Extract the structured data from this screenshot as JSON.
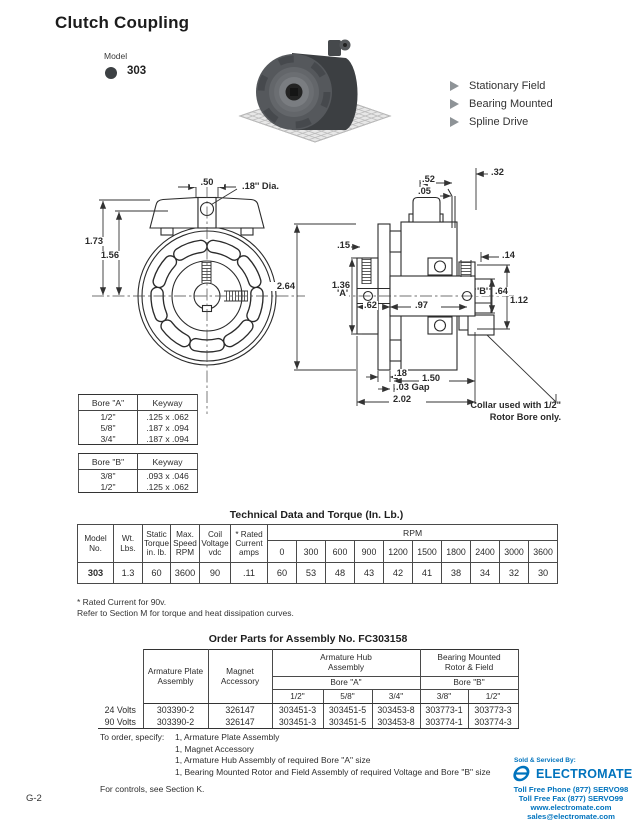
{
  "page_number": "G-2",
  "header": {
    "title": "Clutch Coupling",
    "model_label": "Model",
    "model_number": "303"
  },
  "features": [
    "Stationary Field",
    "Bearing Mounted",
    "Spline Drive"
  ],
  "icons": {
    "feature_bullet": "triangle-right-icon",
    "model_bullet": "filled-circle-icon",
    "vendor_logo": "electromate-e-icon"
  },
  "drawing": {
    "dims": {
      "d50": ".50",
      "dia18": ".18'' Dia.",
      "d173": "1.73",
      "d156": "1.56",
      "d264": "2.64",
      "d15": ".15",
      "d52": ".52",
      "d05": ".05",
      "d32": ".32",
      "d14": ".14",
      "d136": "1.36",
      "dA": "'A'",
      "d62": ".62",
      "d97": ".97",
      "dB": "'B'",
      "d64": ".64",
      "d112": "1.12",
      "d18": ".18",
      "d03": ".03 Gap",
      "d150": "1.50",
      "d202": "2.02"
    },
    "collar_note": "Collar used with 1/2\"\nRotor Bore only."
  },
  "bore_tables": [
    {
      "headers": [
        "Bore \"A\"",
        "Keyway"
      ],
      "rows": [
        [
          "1/2\"",
          ".125 x .062"
        ],
        [
          "5/8\"",
          ".187 x .094"
        ],
        [
          "3/4\"",
          ".187 x .094"
        ]
      ]
    },
    {
      "headers": [
        "Bore \"B\"",
        "Keyway"
      ],
      "rows": [
        [
          "3/8\"",
          ".093 x .046"
        ],
        [
          "1/2\"",
          ".125 x .062"
        ]
      ]
    }
  ],
  "tech_table": {
    "title": "Technical Data and Torque (In. Lb.)",
    "headers": [
      "Model\nNo.",
      "Wt.\nLbs.",
      "Static\nTorque\nin. lb.",
      "Max.\nSpeed\nRPM",
      "Coil\nVoltage\nvdc",
      "* Rated\nCurrent\namps"
    ],
    "rpm_label": "RPM",
    "rpm_cols": [
      "0",
      "300",
      "600",
      "900",
      "1200",
      "1500",
      "1800",
      "2400",
      "3000",
      "3600"
    ],
    "row": {
      "model": "303",
      "wt": "1.3",
      "torque": "60",
      "speed": "3600",
      "voltage": "90",
      "amps": ".11",
      "rpm": [
        "60",
        "53",
        "48",
        "43",
        "42",
        "41",
        "38",
        "34",
        "32",
        "30"
      ]
    }
  },
  "footnotes": [
    "* Rated Current for 90v.",
    "Refer to Section M for torque and heat dissipation curves."
  ],
  "order_table": {
    "title": "Order Parts for Assembly No. FC303158",
    "headers": {
      "armature_plate": "Armature Plate\nAssembly",
      "magnet": "Magnet\nAccessory",
      "hub_group": "Armature Hub\nAssembly",
      "rotor_group": "Bearing Mounted\nRotor & Field",
      "bore_a": "Bore \"A\"",
      "bore_b": "Bore \"B\"",
      "a_sizes": [
        "1/2\"",
        "5/8\"",
        "3/4\""
      ],
      "b_sizes": [
        "3/8\"",
        "1/2\""
      ]
    },
    "rows": [
      {
        "voltage": "24 Volts",
        "plate": "303390-2",
        "magnet": "326147",
        "a": [
          "303451-3",
          "303451-5",
          "303453-8"
        ],
        "b": [
          "303773-1",
          "303773-3"
        ]
      },
      {
        "voltage": "90 Volts",
        "plate": "303390-2",
        "magnet": "326147",
        "a": [
          "303451-3",
          "303451-5",
          "303453-8"
        ],
        "b": [
          "303774-1",
          "303774-3"
        ]
      }
    ]
  },
  "order_notes": {
    "label": "To order, specify:",
    "items": [
      "1, Armature Plate Assembly",
      "1, Magnet Accessory",
      "1, Armature Hub Assembly of required Bore \"A\" size",
      "1, Bearing Mounted Rotor and Field Assembly of required Voltage and Bore \"B\" size"
    ],
    "controls": "For controls, see Section K."
  },
  "vendor": {
    "sold_by": "Sold & Serviced By:",
    "name": "ELECTROMATE",
    "phone": "Toll Free Phone  (877) SERVO98",
    "fax": "Toll Free Fax  (877) SERVO99",
    "web": "www.electromate.com",
    "email": "sales@electromate.com",
    "brand_color": "#0073bd"
  }
}
